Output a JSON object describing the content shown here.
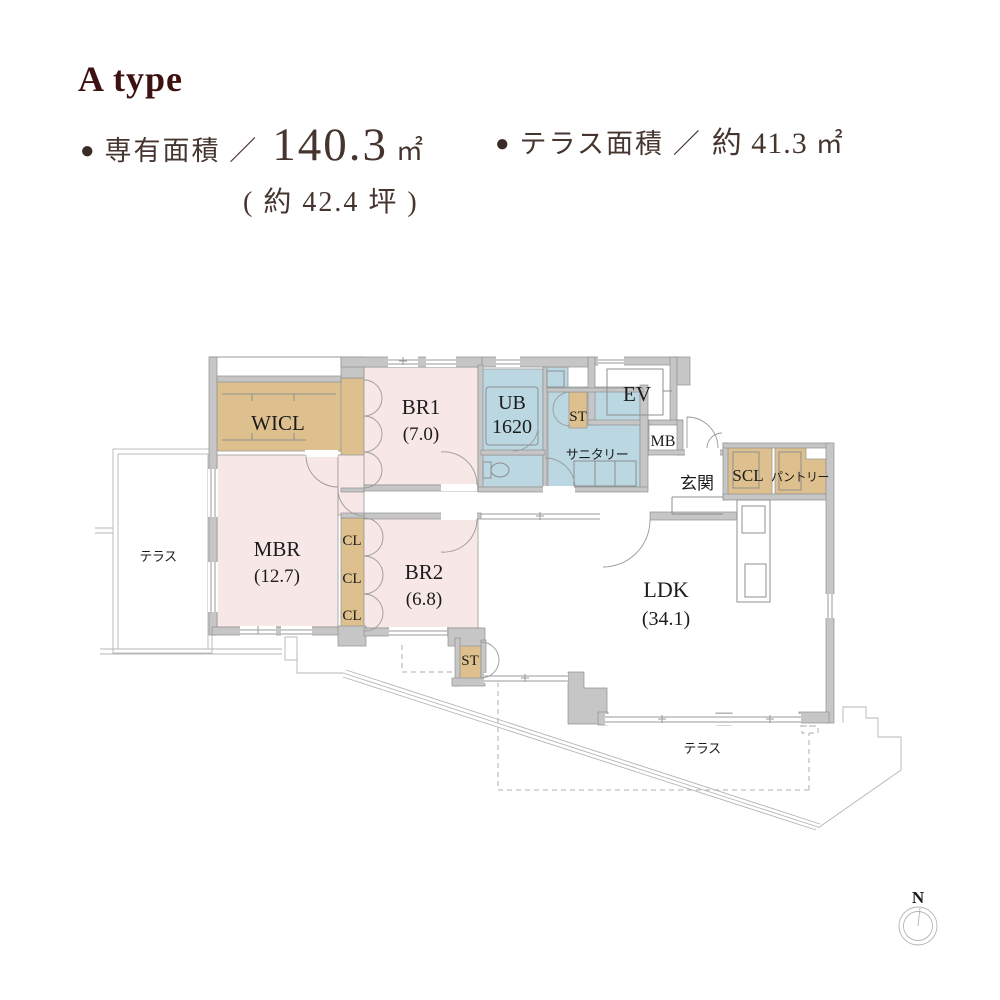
{
  "header": {
    "plan_type": "A type",
    "bullet": "●",
    "exclusive": {
      "label": "専有面積 ／",
      "value": "140.3",
      "unit": "㎡",
      "tsubo": "( 約 42.4 坪 )"
    },
    "terrace": {
      "label": "テラス面積 ／",
      "value": "約 41.3",
      "unit": "㎡"
    }
  },
  "plan": {
    "rooms": {
      "wicl": {
        "label": "WICL"
      },
      "br1": {
        "label": "BR1",
        "area": "(7.0)"
      },
      "ub": {
        "label": "UB",
        "size": "1620"
      },
      "st_upper": {
        "label": "ST"
      },
      "sanitary": {
        "label": "サニタリー"
      },
      "ev": {
        "label": "EV"
      },
      "mb": {
        "label": "MB"
      },
      "genkan": {
        "label": "玄関"
      },
      "scl": {
        "label": "SCL"
      },
      "pantry": {
        "label": "パントリー"
      },
      "mbr": {
        "label": "MBR",
        "area": "(12.7)"
      },
      "cl1": {
        "label": "CL"
      },
      "cl2": {
        "label": "CL"
      },
      "cl3": {
        "label": "CL"
      },
      "br2": {
        "label": "BR2",
        "area": "(6.8)"
      },
      "ldk": {
        "label": "LDK",
        "area": "(34.1)"
      },
      "st_lower": {
        "label": "ST"
      },
      "terrace_west": {
        "label": "テラス"
      },
      "terrace_south": {
        "label": "テラス"
      }
    },
    "compass": {
      "label": "N"
    }
  },
  "colors": {
    "maroon": "#3d1111",
    "header-text": "#46352f",
    "bullet": "#3a2b26",
    "room-pink": "#f8e7e7",
    "room-tan": "#dec08f",
    "room-blue": "#bad7e2",
    "wall-fill": "#c6c6c6",
    "wall-edge": "#919191",
    "line": "#9a9a9a",
    "label": "#1c1c1c"
  }
}
